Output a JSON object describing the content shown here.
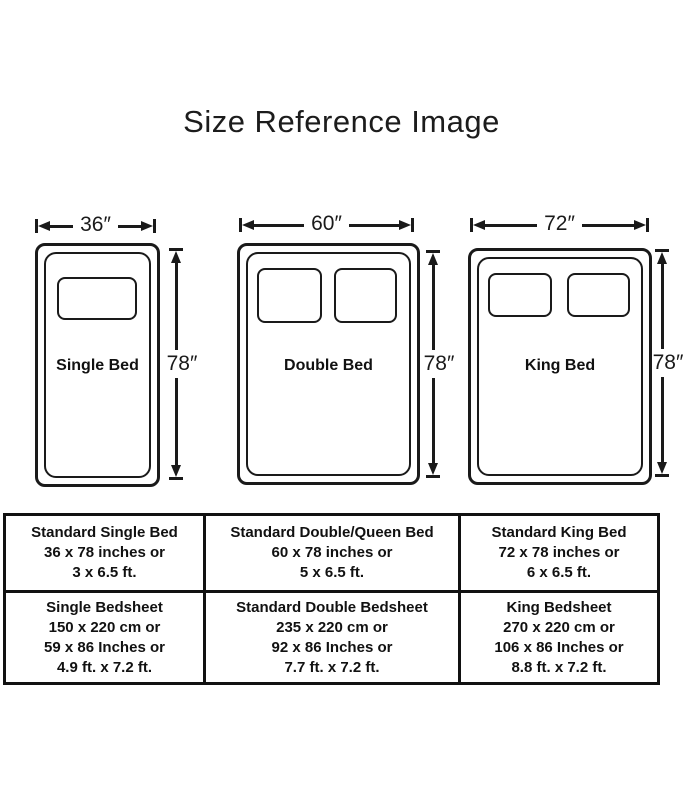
{
  "title": "Size Reference Image",
  "beds": [
    {
      "name": "Single Bed",
      "width_label": "36″",
      "height_label": "78″"
    },
    {
      "name": "Double Bed",
      "width_label": "60″",
      "height_label": "78″"
    },
    {
      "name": "King Bed",
      "width_label": "72″",
      "height_label": "78″"
    }
  ],
  "table": {
    "rows": [
      [
        [
          "Standard Single Bed",
          "36 x 78 inches or",
          "3 x 6.5 ft."
        ],
        [
          "Standard Double/Queen Bed",
          "60 x 78 inches or",
          "5 x 6.5 ft."
        ],
        [
          "Standard King Bed",
          "72 x 78 inches or",
          "6 x 6.5 ft."
        ]
      ],
      [
        [
          "Single Bedsheet",
          "150 x 220 cm or",
          "59 x 86 Inches or",
          "4.9 ft. x 7.2 ft."
        ],
        [
          "Standard Double Bedsheet",
          "235 x 220 cm or",
          "92 x 86 Inches or",
          "7.7 ft. x 7.2 ft."
        ],
        [
          "King Bedsheet",
          "270 x 220 cm or",
          "106 x 86 Inches or",
          "8.8 ft. x 7.2 ft."
        ]
      ]
    ]
  }
}
